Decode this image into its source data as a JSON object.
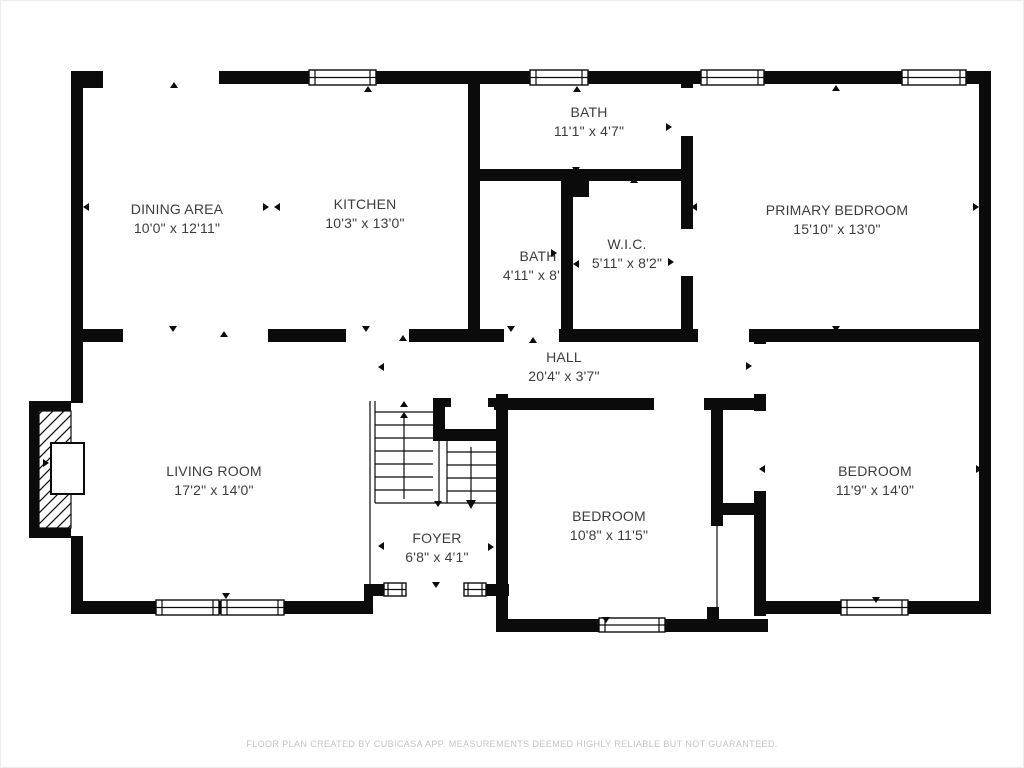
{
  "rooms": [
    {
      "id": "dining-area",
      "name": "DINING AREA",
      "dims": "10'0\" x 12'11\""
    },
    {
      "id": "kitchen",
      "name": "KITCHEN",
      "dims": "10'3\" x 13'0\""
    },
    {
      "id": "bath-top",
      "name": "BATH",
      "dims": "11'1\" x 4'7\""
    },
    {
      "id": "bath",
      "name": "BATH",
      "dims": "4'11\" x 8'1\""
    },
    {
      "id": "walk-in-closet",
      "name": "W.I.C.",
      "dims": "5'11\" x 8'2\""
    },
    {
      "id": "primary-bedroom",
      "name": "PRIMARY BEDROOM",
      "dims": "15'10\" x 13'0\""
    },
    {
      "id": "hall",
      "name": "HALL",
      "dims": "20'4\" x 3'7\""
    },
    {
      "id": "living-room",
      "name": "LIVING ROOM",
      "dims": "17'2\" x 14'0\""
    },
    {
      "id": "foyer",
      "name": "FOYER",
      "dims": "6'8\" x 4'1\""
    },
    {
      "id": "bedroom-middle",
      "name": "BEDROOM",
      "dims": "10'8\" x 11'5\""
    },
    {
      "id": "bedroom-right",
      "name": "BEDROOM",
      "dims": "11'9\" x 14'0\""
    }
  ],
  "footer": {
    "text": "FLOOR PLAN CREATED BY CUBICASA APP. MEASUREMENTS DEEMED HIGHLY RELIABLE BUT NOT GUARANTEED."
  },
  "colors": {
    "wall": "#0b0b0b",
    "label": "#3d3d3d",
    "footer": "#c4c4c4"
  }
}
